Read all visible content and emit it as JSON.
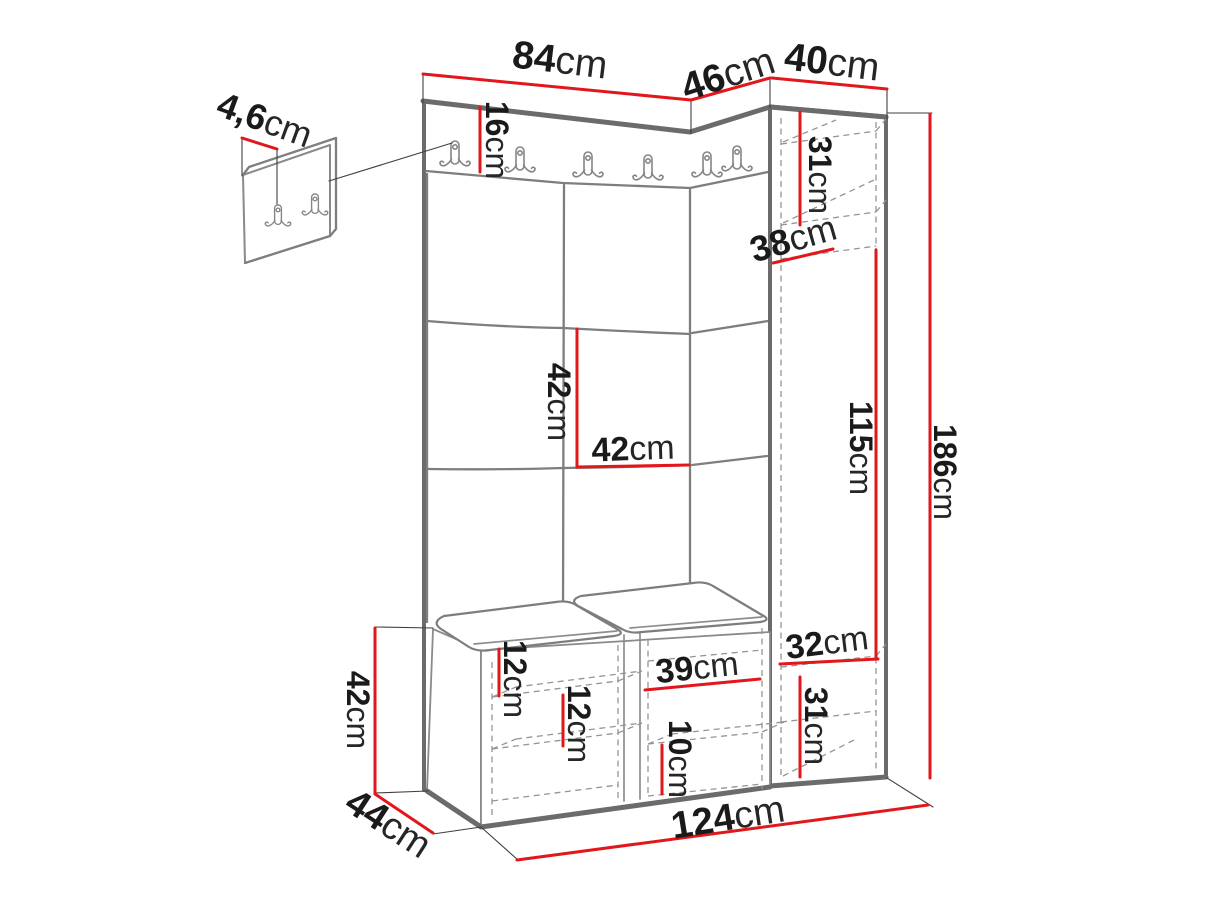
{
  "diagram": {
    "type": "furniture-dimension-diagram",
    "subject": "hallway wardrobe set: hook rail with coat hooks, upholstered panel wall, corner panel, tall side cabinet and shoe storage bench, plus separate hook plate detail",
    "unit": "cm",
    "accent_color": "#e2171b",
    "line_color": "#8a8a8a",
    "text_color": "#1a1a1a",
    "labels": {
      "main_width": {
        "value": "84",
        "unit": "cm"
      },
      "corner_width": {
        "value": "46",
        "unit": "cm"
      },
      "cabinet_width": {
        "value": "40",
        "unit": "cm"
      },
      "hook_plate_offset": {
        "value": "4,6",
        "unit": "cm"
      },
      "rail_height": {
        "value": "16",
        "unit": "cm"
      },
      "cabinet_top_shelf": {
        "value": "31",
        "unit": "cm"
      },
      "cabinet_shelf_depth": {
        "value": "38",
        "unit": "cm"
      },
      "panel_tile_height": {
        "value": "42",
        "unit": "cm"
      },
      "panel_tile_width": {
        "value": "42",
        "unit": "cm"
      },
      "cabinet_inner_height": {
        "value": "115",
        "unit": "cm"
      },
      "total_height": {
        "value": "186",
        "unit": "cm"
      },
      "cabinet_bottom_width": {
        "value": "32",
        "unit": "cm"
      },
      "cabinet_bottom_height": {
        "value": "31",
        "unit": "cm"
      },
      "bench_top_gap": {
        "value": "12",
        "unit": "cm"
      },
      "bench_shelf_gap": {
        "value": "12",
        "unit": "cm"
      },
      "bench_niche_width": {
        "value": "39",
        "unit": "cm"
      },
      "bench_niche_shelf": {
        "value": "10",
        "unit": "cm"
      },
      "bench_height": {
        "value": "42",
        "unit": "cm"
      },
      "bench_depth": {
        "value": "44",
        "unit": "cm"
      },
      "total_width": {
        "value": "124",
        "unit": "cm"
      }
    }
  }
}
